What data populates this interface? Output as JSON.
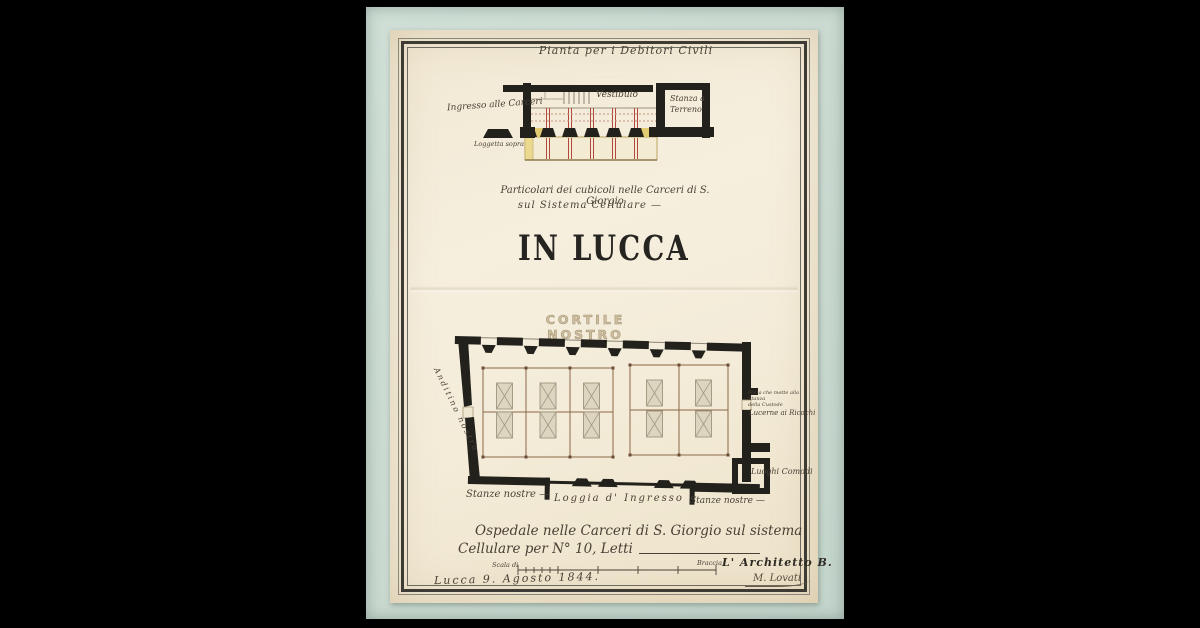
{
  "archive_note": "C/ N° 21",
  "top_plan": {
    "title": "Pianta per i Debitori Civili",
    "entrance_label": "Ingresso alle Carceri",
    "vestibule_label": "Vestibulo",
    "ground_room_label_line1": "Stanza a",
    "ground_room_label_line2": "Terreno",
    "loggia_note": "Loggetta sopra"
  },
  "caption": {
    "line1": "Particolari dei cubicoli nelle Carceri di S. Giorgio",
    "line2": "sul Sistema Cellulare —"
  },
  "main_title": "IN LUCCA",
  "floor_plan": {
    "courtyard_label": "CORTILE NOSTRO",
    "corridor_label": "Anditino nostro",
    "door_note_line1": "Porta che mette alla Stanza",
    "door_note_line2": "della Custode",
    "lucerne_label": "Lucerne ai Ricochi",
    "toilets_label": "Luoghi Comodi",
    "rooms_left_label": "Stanze nostre —",
    "loggia_label": "Loggia d' Ingresso",
    "rooms_right_label": "Stanze nostre —"
  },
  "footer": {
    "caption_line1": "Ospedale nelle Carceri di S. Giorgio sul sistema",
    "caption_line2": "Cellulare per N° 10, Letti",
    "scale_label": "Scala di",
    "scale_unit": "Braccia",
    "architect_label": "L' Architetto B.",
    "signature": "M. Lovati",
    "date_line": "Lucca 9. Agosto 1844."
  },
  "colors": {
    "mount": "#ccdbd2",
    "paper": "#f4ecda",
    "ink": "#23211c",
    "red_ink": "#b2473d",
    "sepia": "#8a6848",
    "yellow_wash": "#e2cb70"
  }
}
